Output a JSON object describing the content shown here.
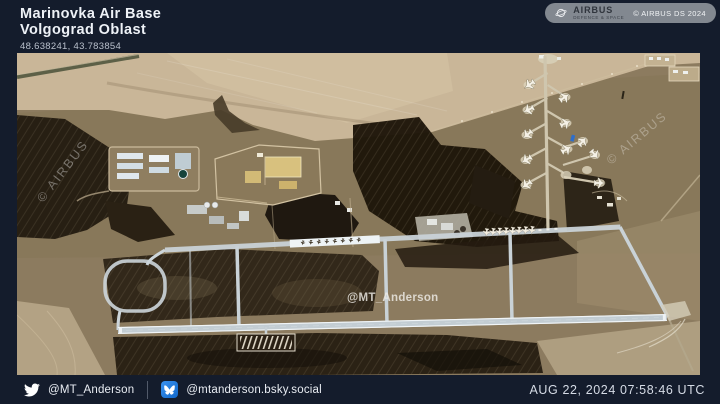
{
  "header": {
    "title": "Marinovka Air Base",
    "subtitle": "Volgograd Oblast",
    "coordinates": "48.638241, 43.783854"
  },
  "credit_badge": {
    "brand": "AIRBUS",
    "brand_sub": "DEFENCE & SPACE",
    "copyright": "© AIRBUS DS 2024"
  },
  "watermarks": {
    "airbus_left": "© AIRBUS",
    "airbus_right": "© AIRBUS",
    "author": "@MT_Anderson"
  },
  "footer": {
    "twitter_handle": "@MT_Anderson",
    "bluesky_handle": "@mtanderson.bsky.social",
    "timestamp": "AUG 22, 2024 07:58:46 UTC"
  },
  "colors": {
    "background": "#141c2c",
    "credit_pill_gray": "#92979e",
    "bluesky_blue": "#1185fe",
    "field_tan": "#c9b698",
    "burned_ground": "#221a10",
    "runway_pavement": "#dfe6ea"
  }
}
